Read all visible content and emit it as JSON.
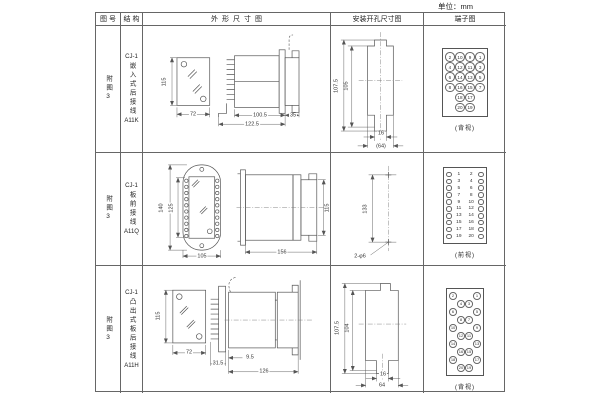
{
  "unit_label": "单位：mm",
  "table": {
    "headers": [
      "图号",
      "结构",
      "外形尺寸图",
      "安装开孔尺寸图",
      "端子图"
    ]
  },
  "rows": [
    {
      "figure_no": "附图3",
      "structure": {
        "series": "CJ-1",
        "desc": "嵌入式后接线",
        "code": "A11K"
      },
      "outline": {
        "front_height": "115",
        "front_width": "72",
        "body_depth": "100.5",
        "total_depth": "122.5",
        "rear_depth": "35"
      },
      "install": {
        "outer_height": "107.5",
        "inner_height": "105",
        "slot_width": "16",
        "overall_width": "(64)"
      },
      "terminal": {
        "view": "(背视)",
        "grid": [
          [
            "2",
            "10",
            "9",
            "1"
          ],
          [
            "4",
            "12",
            "11",
            "3"
          ],
          [
            "6",
            "14",
            "13",
            "5"
          ],
          [
            "8",
            "16",
            "15",
            "7"
          ],
          [
            "",
            "18",
            "17",
            ""
          ],
          [
            "",
            "20",
            "19",
            ""
          ]
        ]
      }
    },
    {
      "figure_no": "附图3",
      "structure": {
        "series": "CJ-1",
        "desc": "板前接线",
        "code": "A11Q"
      },
      "outline": {
        "front_height": "140",
        "window_height": "125",
        "front_width": "105",
        "body_depth": "156",
        "side_height": "115"
      },
      "install": {
        "hole_spacing": "133",
        "holes": "2-φ6"
      },
      "terminal": {
        "view": "(前视)",
        "pairs": [
          [
            "1",
            "2"
          ],
          [
            "3",
            "4"
          ],
          [
            "5",
            "6"
          ],
          [
            "7",
            "8"
          ],
          [
            "9",
            "10"
          ],
          [
            "11",
            "12"
          ],
          [
            "13",
            "14"
          ],
          [
            "15",
            "16"
          ],
          [
            "17",
            "18"
          ],
          [
            "19",
            "20"
          ]
        ]
      }
    },
    {
      "figure_no": "附图3",
      "structure": {
        "series": "CJ-1",
        "desc": "凸出式板后接线",
        "code": "A11H"
      },
      "outline": {
        "front_height": "115",
        "front_width": "72",
        "bracket_depth": "31.5",
        "gap_depth": "9.5",
        "body_depth": "126"
      },
      "install": {
        "outer_height": "107.5",
        "inner_height": "104",
        "slot_width": "16",
        "overall_width": "64"
      },
      "terminal": {
        "view": "(背视)",
        "grid": [
          [
            "2",
            "",
            "",
            "1"
          ],
          [
            "",
            "4",
            "3",
            ""
          ],
          [
            "6",
            "",
            "",
            "5"
          ],
          [
            "",
            "8",
            "7",
            ""
          ],
          [
            "10",
            "",
            "",
            "9"
          ],
          [
            "",
            "12",
            "11",
            ""
          ],
          [
            "14",
            "",
            "",
            "13"
          ],
          [
            "",
            "16",
            "15",
            ""
          ],
          [
            "18",
            "",
            "",
            "17"
          ],
          [
            "",
            "20",
            "19",
            ""
          ]
        ]
      }
    }
  ]
}
